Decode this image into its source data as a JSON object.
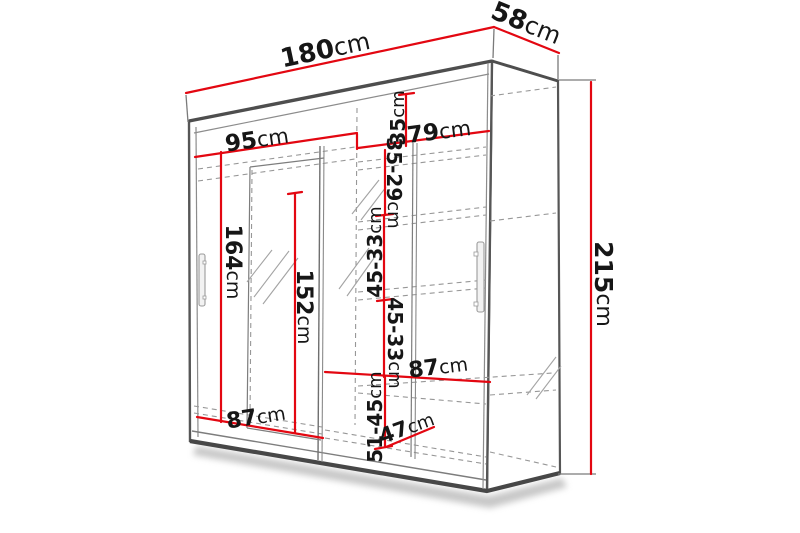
{
  "diagram": {
    "type": "furniture-dimension-diagram",
    "subject": "sliding-door wardrobe with mirror",
    "unit": "cm",
    "colors": {
      "dimension_line": "#e30711",
      "outline": "#4f4f4f",
      "inner_line": "#8c8c8c",
      "text": "#161616",
      "background": "#ffffff"
    },
    "dims": {
      "total_width": {
        "num": "180",
        "unit": "cm"
      },
      "top_depth": {
        "num": "58",
        "unit": "cm"
      },
      "total_height": {
        "num": "215",
        "unit": "cm"
      },
      "left_inner_width": {
        "num": "95",
        "unit": "cm"
      },
      "right_inner_width": {
        "num": "79",
        "unit": "cm"
      },
      "top_gap": {
        "num": "35",
        "unit": "cm"
      },
      "shelf_gap_top": {
        "num": "35-29",
        "unit": "cm"
      },
      "shelf_gap_mid": {
        "num": "45-33",
        "unit": "cm"
      },
      "shelf_gap_lower": {
        "num": "45-33",
        "unit": "cm"
      },
      "hanging_height": {
        "num": "164",
        "unit": "cm"
      },
      "mirror_height": {
        "num": "152",
        "unit": "cm"
      },
      "mid_shelf_width": {
        "num": "87",
        "unit": "cm"
      },
      "bottom_width": {
        "num": "87",
        "unit": "cm"
      },
      "bottom_gap": {
        "num": "51-45",
        "unit": "cm"
      },
      "bottom_depth": {
        "num": "47",
        "unit": "cm"
      }
    }
  }
}
